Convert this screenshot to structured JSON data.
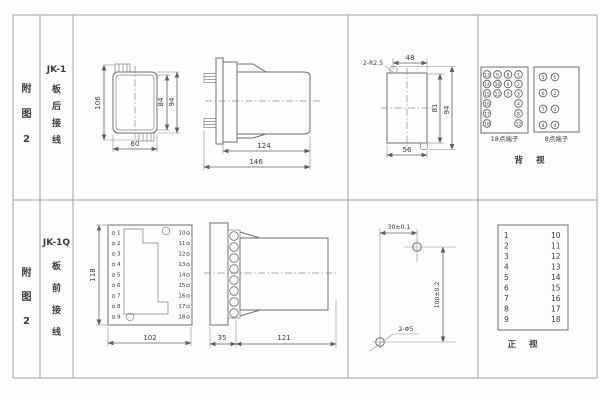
{
  "page": {
    "background": "#fdfdfc",
    "line_color": "#6e6e6e",
    "text_color": "#3c3c3c"
  },
  "left_panel": {
    "row1": {
      "figure": [
        "附",
        "图",
        "2"
      ],
      "model": "JK-1",
      "wiring": [
        "板",
        "后",
        "接",
        "线"
      ]
    },
    "row2": {
      "figure": [
        "附",
        "图",
        "2"
      ],
      "model": "JK-1Q",
      "wiring": [
        "板",
        "前",
        "接",
        "线"
      ]
    }
  },
  "row1": {
    "front_view": {
      "dim_overall_height": "106",
      "dim_inner_height": "84",
      "dim_case_height": "94",
      "dim_width": "60"
    },
    "side_view": {
      "dim_body_length": "124",
      "dim_overall_length": "146"
    },
    "cutout_view": {
      "corner_radius": "2-R2.5",
      "dim_top_width": "48",
      "dim_inner_height": "81",
      "dim_overall_height": "94",
      "dim_bottom_width": "56"
    },
    "rear_view": {
      "label_18": "18点端子",
      "label_8": "8点端子",
      "view_label": "背 视",
      "t18_grid": [
        [
          "13",
          "9",
          "5",
          "1"
        ],
        [
          "14",
          "10",
          "6",
          "2"
        ],
        [
          "15",
          "11",
          "7",
          "3"
        ]
      ],
      "t18_left": [
        "16",
        "17",
        "18"
      ],
      "t18_right": [
        "4",
        "8",
        "12"
      ],
      "t8_grid": [
        [
          "5",
          "1"
        ],
        [
          "6",
          "2"
        ],
        [
          "7",
          "3"
        ],
        [
          "8",
          "4"
        ]
      ]
    }
  },
  "row2": {
    "front_view": {
      "dim_height": "118",
      "dim_width": "102",
      "left_terminals": [
        "1",
        "2",
        "3",
        "4",
        "5",
        "6",
        "7",
        "8",
        "9"
      ],
      "right_terminals": [
        "10",
        "11",
        "12",
        "13",
        "14",
        "15",
        "16",
        "17",
        "18"
      ]
    },
    "side_view": {
      "dim_flange": "35",
      "dim_body_length": "121"
    },
    "drill_view": {
      "dim_horizontal": "30±0.1",
      "dim_vertical": "100±0.2",
      "hole_label": "2-Φ5"
    },
    "front_table": {
      "view_label": "正 视",
      "left": [
        "1",
        "2",
        "3",
        "4",
        "5",
        "6",
        "7",
        "8",
        "9"
      ],
      "right": [
        "10",
        "11",
        "12",
        "13",
        "14",
        "15",
        "16",
        "17",
        "18"
      ]
    }
  }
}
